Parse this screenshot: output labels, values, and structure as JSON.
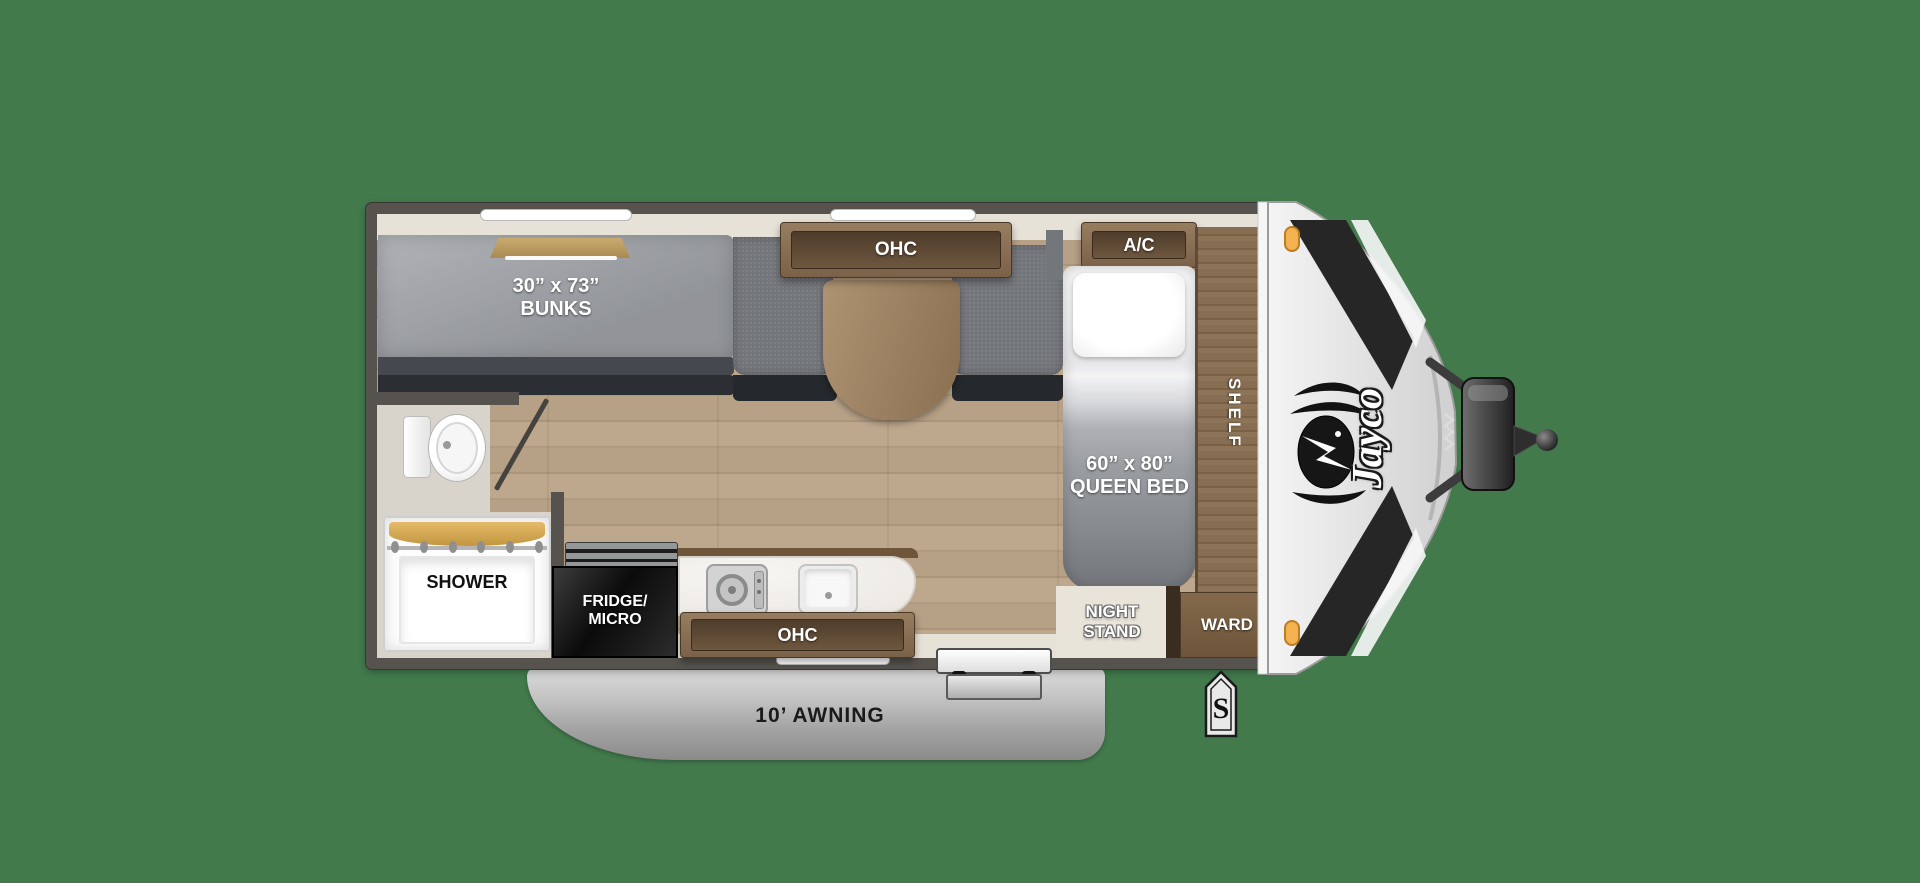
{
  "title": "Jayco travel trailer floor plan",
  "colors": {
    "background_green": "#427a4c",
    "wall_gray": "#56524d",
    "wood_floor": "#b5a086",
    "bath_floor": "#d8d4cb",
    "cabinet_wood": "#8a7158",
    "mattress_gray": "#9ea1a6",
    "bench_gray": "#73767b",
    "counter_white": "#f2f0ed",
    "fridge_black": "#151515",
    "awning_gray": "#b9b9b9",
    "cap_silver": "#e6e6e6",
    "marker_orange": "#f3b14f"
  },
  "labels": {
    "bunks": "30” x 73”\nBUNKS",
    "dinette_ohc": "OHC",
    "ac": "A/C",
    "queen_bed": "60” x 80”\nQUEEN BED",
    "shelf": "SHELF",
    "night_stand": "NIGHT\nSTAND",
    "ward": "WARD",
    "shower": "SHOWER",
    "fridge_micro": "FRIDGE/\nMICRO",
    "kitchen_ohc": "OHC",
    "awning": "10’ AWNING",
    "stabilizer": "S",
    "brand": "Jayco"
  }
}
